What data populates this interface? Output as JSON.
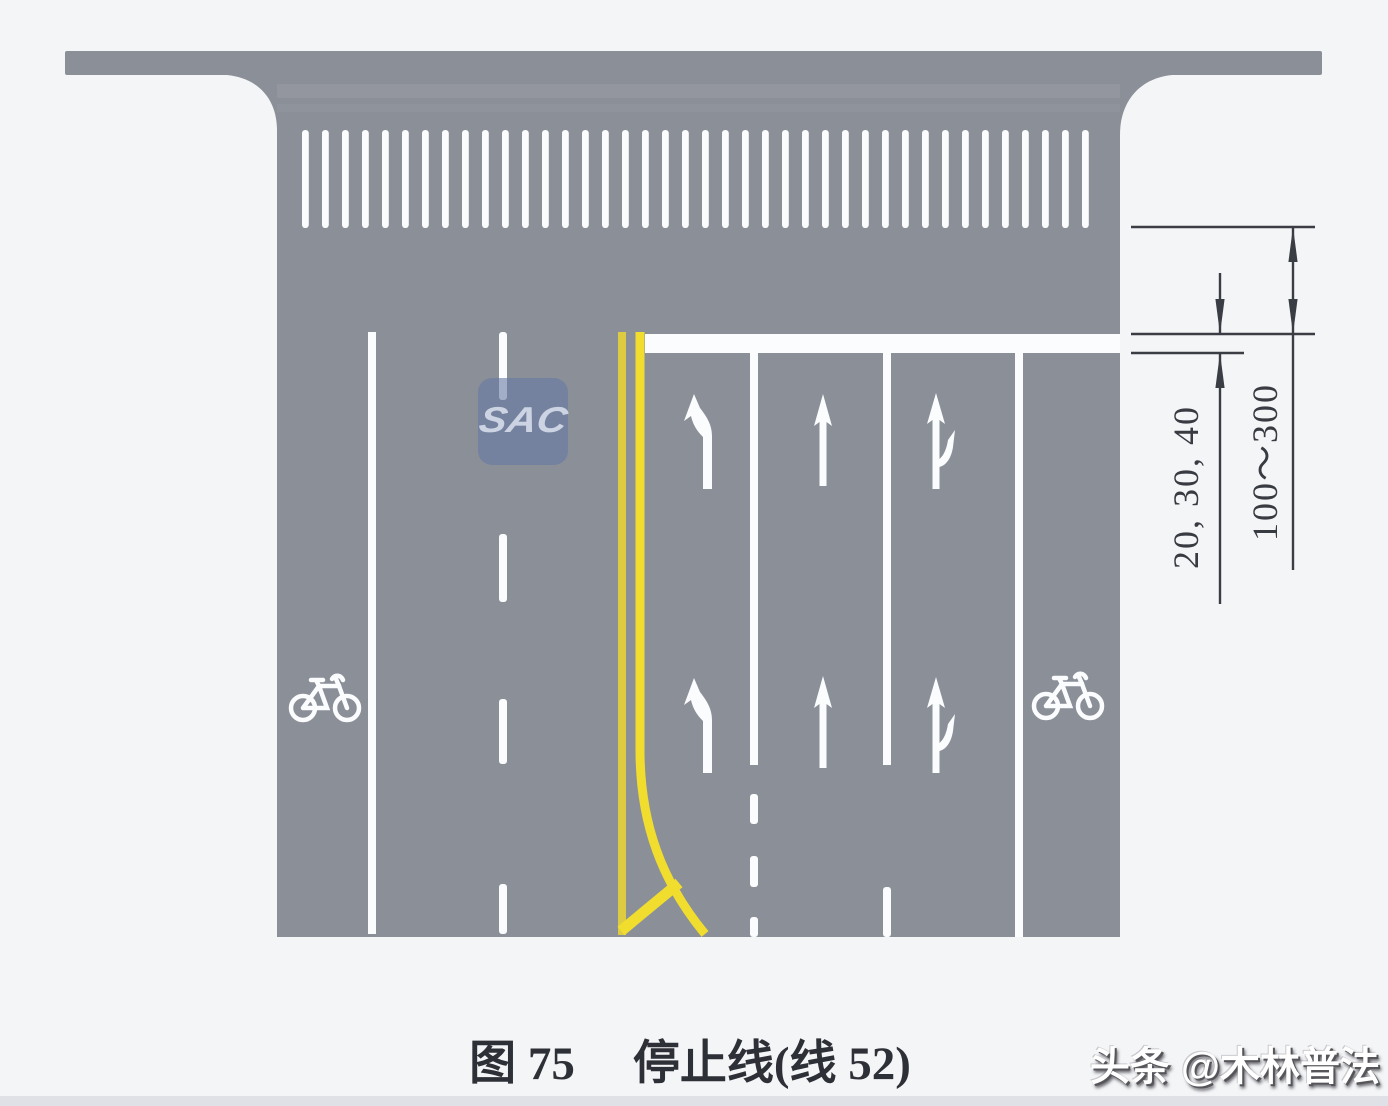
{
  "figure": {
    "caption_label": "图 75",
    "caption_title": "停止线(线 52)"
  },
  "dimensions": {
    "stop_line_width_label": "20, 30, 40",
    "crosswalk_distance_label": "100～300"
  },
  "watermarks": {
    "publisher": "头条 @木林普法",
    "logo": "SAC"
  },
  "road": {
    "lane_markings": [
      "left-turn",
      "straight",
      "straight-right",
      "bicycle"
    ],
    "colors": {
      "surface": "#8b8f98",
      "marking_white": "#fbfcfd",
      "center_line_yellow": "#ecd936",
      "dimension_ink": "#3a3d44",
      "background": "#f4f5f7"
    }
  }
}
